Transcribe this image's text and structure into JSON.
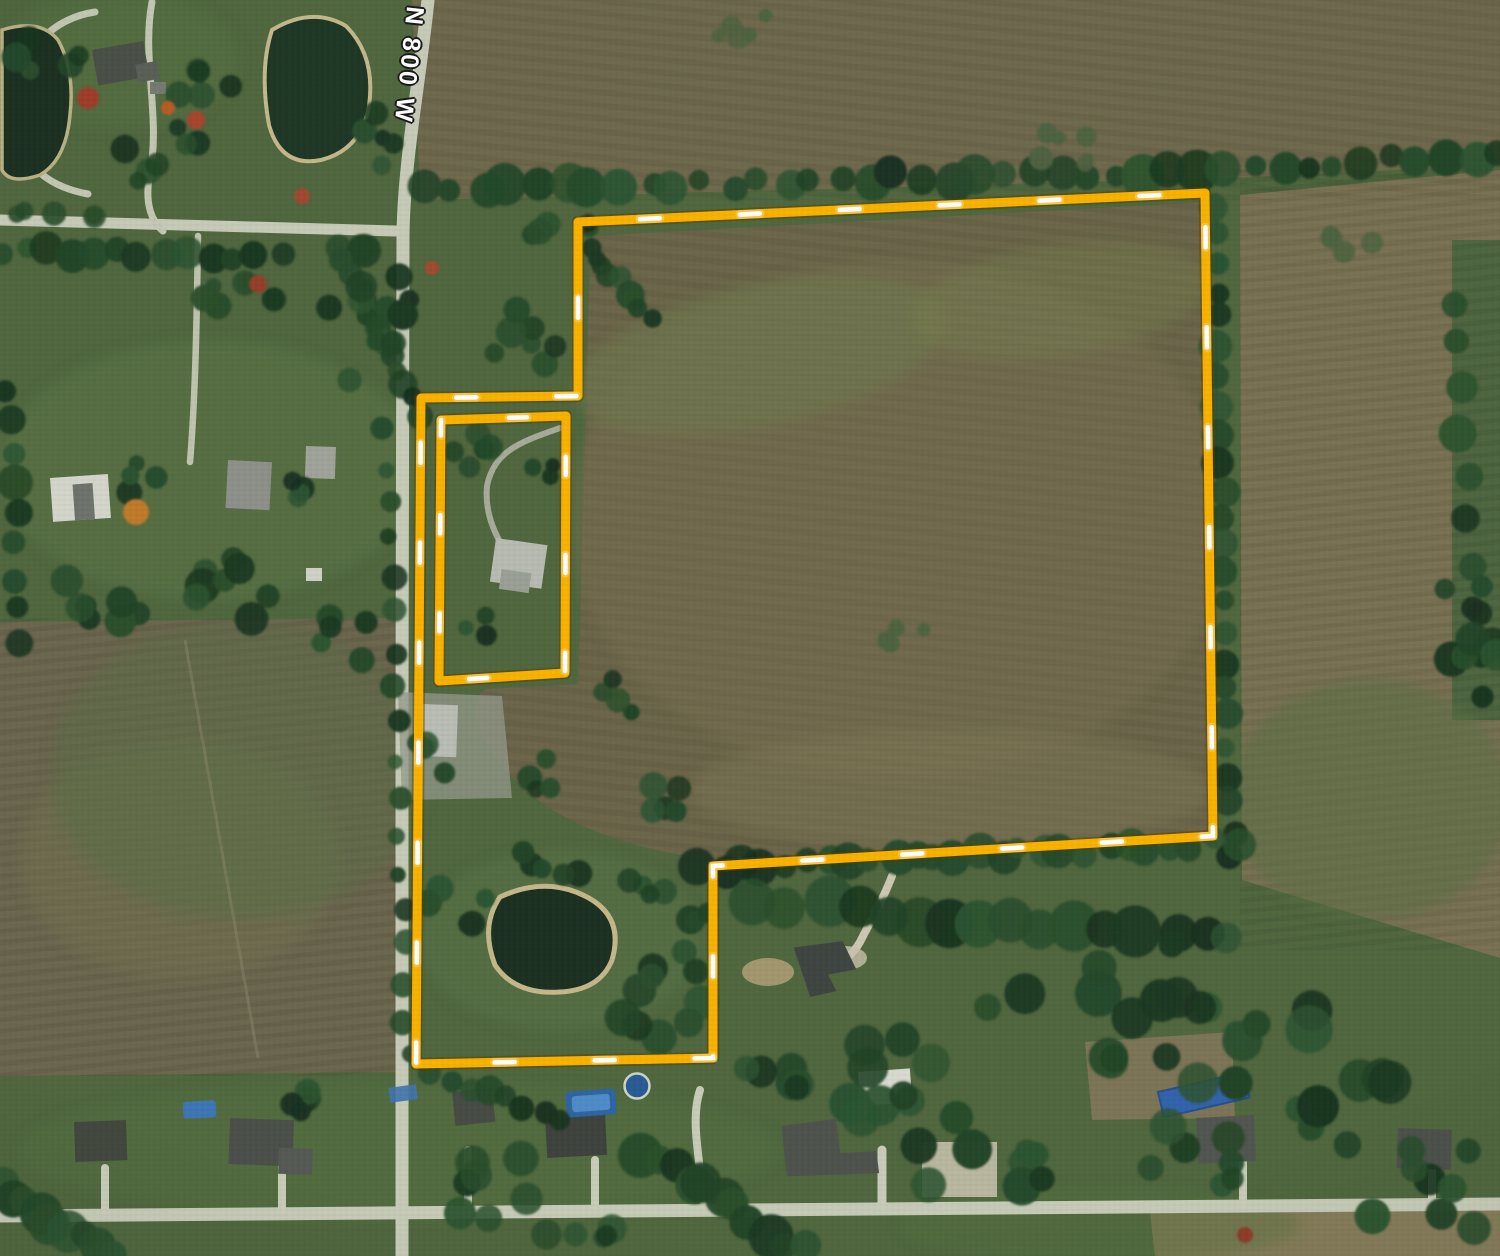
{
  "map": {
    "road_label": "N 800 W"
  },
  "colors": {
    "boundary_gold": "#F9B200",
    "boundary_dash_white": "#FFFFFF",
    "boundary_shadow": "#5C3E00",
    "road": "#C6CBB7",
    "water_dark": "#1C3122",
    "pond_rim_tan": "#C4B88A",
    "pool_blue": "#3E76B4"
  },
  "parcel": {
    "outer": [
      [
        578,
        222
      ],
      [
        1205,
        193
      ],
      [
        1213,
        836
      ],
      [
        713,
        866
      ],
      [
        713,
        1058
      ],
      [
        416,
        1064
      ],
      [
        421,
        398
      ],
      [
        578,
        396
      ]
    ],
    "inner_exclusion": [
      [
        441,
        420
      ],
      [
        566,
        416
      ],
      [
        565,
        673
      ],
      [
        439,
        681
      ]
    ]
  }
}
